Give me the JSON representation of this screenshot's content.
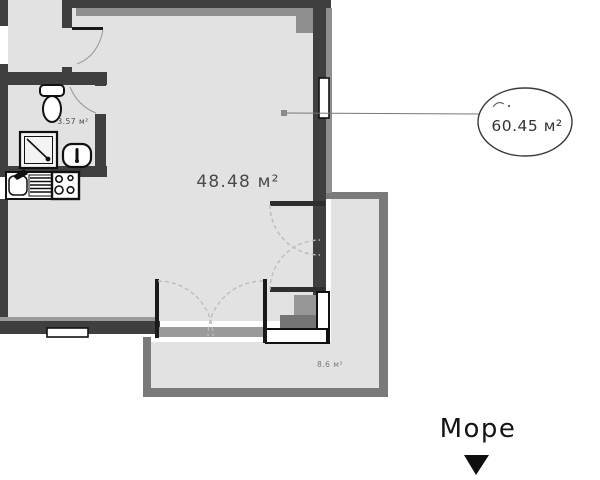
{
  "floor_plan": {
    "rooms": {
      "living": {
        "area": "48.48 м²"
      },
      "bathroom": {
        "area": "3.57 м²"
      },
      "terrace": {
        "area": "8.6 м²"
      }
    },
    "area_callout": {
      "value": "60.45 м²"
    },
    "orientation": {
      "sea_label": "Море",
      "direction_icon": "triangle-down"
    },
    "fixtures": [
      "toilet-icon",
      "shower-icon",
      "washbasin-icon",
      "kitchen-sink-icon",
      "stove-icon"
    ],
    "openings": [
      "entry-door",
      "bathroom-door",
      "double-door-bottom",
      "double-door-right",
      "window-right",
      "window-bottom",
      "window-corner-vertical",
      "window-corner-horizontal"
    ]
  },
  "colors": {
    "wall_dark": "#3f3f3f",
    "wall_mid": "#8f8f8f",
    "wall_light": "#9a9a9a",
    "floor": "#e2e2e2",
    "terrace_border": "#7a7a7a",
    "outline_black": "#111111",
    "door_arc_dash": "#bcbcbc",
    "leader_line": "#777777",
    "text_dark": "#333333"
  }
}
